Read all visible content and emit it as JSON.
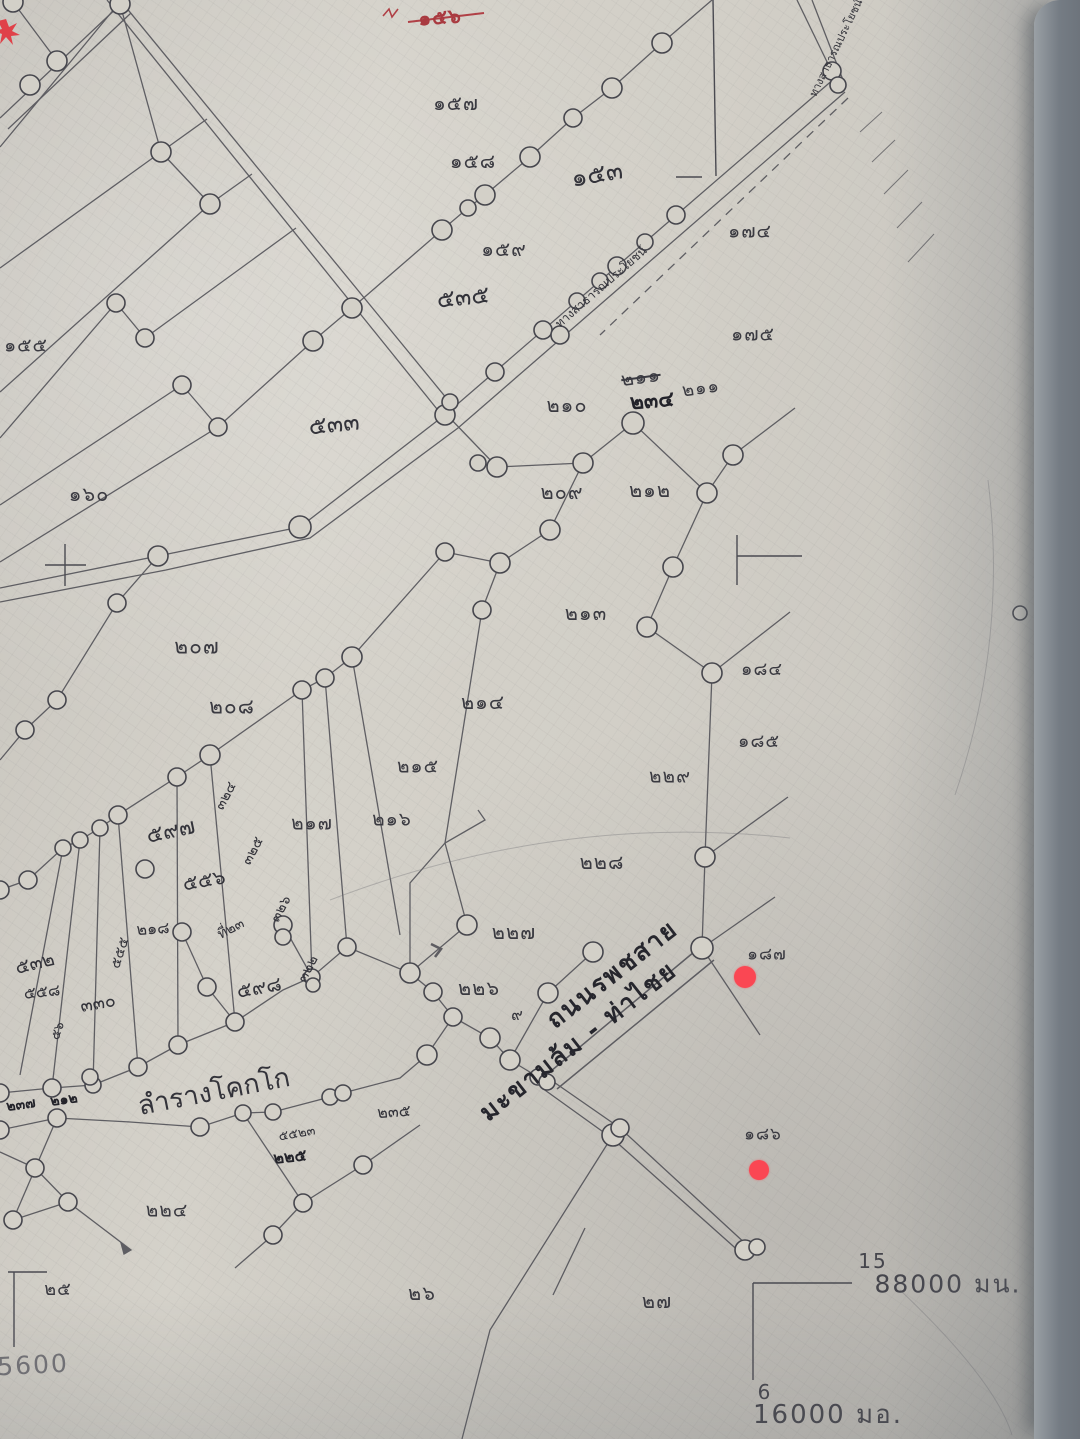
{
  "map": {
    "description": "hand-drawn cadastral survey sheet photo",
    "colors": {
      "paper": "#d2cfc7",
      "ink": "#45454c",
      "red_marker": "#fa4753",
      "red_text": "#a93a40"
    },
    "red_markers": [
      {
        "x": 745,
        "y": 977,
        "r": 11
      },
      {
        "x": 759,
        "y": 1170,
        "r": 10
      }
    ],
    "red_star": {
      "x": 6,
      "y": 31
    },
    "grid": {
      "north_index": "15",
      "north_value": "88000 มน.",
      "east_index": "6",
      "east_value": "16000 มอ.",
      "left_partial": "5600"
    },
    "road_name_line1": "ถนนรพชสาย",
    "road_name_line2": "มะขามล้ม - ท่าไชย",
    "canal_name": "ลำรางโคกโก",
    "labels": [
      {
        "name": "parcel-156-red",
        "text": "๑๕๖",
        "x": 440,
        "y": 17,
        "rot": -4,
        "size": 20,
        "cls": "red-num"
      },
      {
        "name": "parcel-157",
        "text": "๑๕๗",
        "x": 456,
        "y": 103,
        "size": 20
      },
      {
        "name": "parcel-158",
        "text": "๑๕๘",
        "x": 473,
        "y": 161,
        "size": 20
      },
      {
        "name": "parcel-159",
        "text": "๑๕๙",
        "x": 504,
        "y": 249,
        "size": 20
      },
      {
        "name": "parcel-174",
        "text": "๑๗๔",
        "x": 750,
        "y": 232,
        "size": 19
      },
      {
        "name": "parcel-175",
        "text": "๑๗๕",
        "x": 753,
        "y": 335,
        "size": 19
      },
      {
        "name": "parcel-155",
        "text": "๑๕๕",
        "x": 26,
        "y": 346,
        "size": 19
      },
      {
        "name": "parcel-160",
        "text": "๑๖๐",
        "x": 89,
        "y": 494,
        "size": 20
      },
      {
        "name": "hand-153",
        "text": "๑๕๓",
        "x": 597,
        "y": 174,
        "rot": -10,
        "size": 25,
        "cls": "hand"
      },
      {
        "name": "hand-535",
        "text": "๕๓๕",
        "x": 463,
        "y": 297,
        "rot": -6,
        "size": 24,
        "cls": "hand"
      },
      {
        "name": "hand-533",
        "text": "๕๓๓",
        "x": 334,
        "y": 424,
        "rot": -6,
        "size": 24,
        "cls": "hand"
      },
      {
        "name": "parcel-210",
        "text": "๒๑๐",
        "x": 567,
        "y": 405,
        "size": 20
      },
      {
        "name": "parcel-211-struck",
        "text": "๒๑๑",
        "x": 641,
        "y": 378,
        "rot": -8,
        "size": 19,
        "cls": "strike"
      },
      {
        "name": "parcel-234-bold",
        "text": "๒๓๔",
        "x": 652,
        "y": 401,
        "rot": -5,
        "size": 21,
        "cls": "bold-hand"
      },
      {
        "name": "parcel-211b",
        "text": "๒๑๑",
        "x": 701,
        "y": 389,
        "rot": -8,
        "size": 18
      },
      {
        "name": "parcel-209",
        "text": "๒๐๙",
        "x": 562,
        "y": 492,
        "size": 20
      },
      {
        "name": "parcel-212",
        "text": "๒๑๒",
        "x": 650,
        "y": 490,
        "size": 20
      },
      {
        "name": "parcel-213",
        "text": "๒๑๓",
        "x": 586,
        "y": 613,
        "size": 20
      },
      {
        "name": "parcel-207",
        "text": "๒๐๗",
        "x": 197,
        "y": 647,
        "size": 21
      },
      {
        "name": "parcel-208",
        "text": "๒๐๘",
        "x": 232,
        "y": 707,
        "size": 21
      },
      {
        "name": "parcel-214",
        "text": "๒๑๔",
        "x": 483,
        "y": 702,
        "size": 20
      },
      {
        "name": "parcel-215",
        "text": "๒๑๕",
        "x": 418,
        "y": 767,
        "size": 19
      },
      {
        "name": "parcel-217",
        "text": "๒๑๗",
        "x": 312,
        "y": 824,
        "size": 19
      },
      {
        "name": "parcel-216",
        "text": "๒๑๖",
        "x": 392,
        "y": 820,
        "size": 19
      },
      {
        "name": "parcel-184",
        "text": "๑๘๔",
        "x": 762,
        "y": 670,
        "size": 18
      },
      {
        "name": "parcel-185",
        "text": "๑๘๕",
        "x": 759,
        "y": 742,
        "size": 18
      },
      {
        "name": "parcel-229",
        "text": "๒๒๙",
        "x": 670,
        "y": 777,
        "size": 19
      },
      {
        "name": "parcel-228",
        "text": "๒๒๘",
        "x": 602,
        "y": 862,
        "size": 20
      },
      {
        "name": "parcel-227",
        "text": "๒๒๗",
        "x": 514,
        "y": 932,
        "size": 20
      },
      {
        "name": "parcel-226",
        "text": "๒๒๖",
        "x": 479,
        "y": 988,
        "size": 20
      },
      {
        "name": "parcel-187",
        "text": "๑๘๗",
        "x": 767,
        "y": 955,
        "size": 17
      },
      {
        "name": "parcel-186",
        "text": "๑๘๖",
        "x": 763,
        "y": 1135,
        "size": 17
      },
      {
        "name": "parcel-224",
        "text": "๒๒๔",
        "x": 167,
        "y": 1211,
        "size": 19
      },
      {
        "name": "parcel-25",
        "text": "๒๕",
        "x": 58,
        "y": 1290,
        "size": 18
      },
      {
        "name": "parcel-26",
        "text": "๒๖",
        "x": 422,
        "y": 1293,
        "size": 20
      },
      {
        "name": "parcel-27",
        "text": "๒๗",
        "x": 657,
        "y": 1301,
        "size": 20
      },
      {
        "name": "hand-597",
        "text": "๕๙๗",
        "x": 171,
        "y": 832,
        "rot": -12,
        "size": 22,
        "cls": "hand"
      },
      {
        "name": "hand-556",
        "text": "๕๕๖",
        "x": 204,
        "y": 880,
        "rot": -10,
        "size": 20,
        "cls": "hand"
      },
      {
        "name": "hand-598",
        "text": "๕๙๘",
        "x": 259,
        "y": 987,
        "rot": -10,
        "size": 20,
        "cls": "hand"
      },
      {
        "name": "hand-532",
        "text": "๕๓๒",
        "x": 35,
        "y": 964,
        "rot": -14,
        "size": 19,
        "cls": "hand"
      },
      {
        "name": "hand-558",
        "text": "๕๕๘",
        "x": 42,
        "y": 992,
        "rot": -6,
        "size": 16,
        "cls": "hand"
      },
      {
        "name": "hand-330",
        "text": "๓๓๐",
        "x": 98,
        "y": 1004,
        "rot": -10,
        "size": 18,
        "cls": "hand"
      },
      {
        "name": "hand-218",
        "text": "๒๑๘",
        "x": 153,
        "y": 929,
        "rot": -4,
        "size": 16,
        "cls": "hand"
      },
      {
        "name": "hand-note-ti23",
        "text": "ที่๒๓",
        "x": 231,
        "y": 929,
        "rot": -28,
        "size": 14,
        "cls": "hand"
      },
      {
        "name": "hand-225",
        "text": "๒๒๕",
        "x": 290,
        "y": 1157,
        "rot": -6,
        "size": 16,
        "cls": "bold-hand"
      },
      {
        "name": "hand-5523",
        "text": "๕๕๒๓",
        "x": 297,
        "y": 1134,
        "rot": -10,
        "size": 13,
        "cls": "hand"
      },
      {
        "name": "hand-235",
        "text": "๒๓๕",
        "x": 394,
        "y": 1112,
        "rot": -4,
        "size": 16,
        "cls": "hand"
      },
      {
        "name": "hand-237",
        "text": "๒๓๗",
        "x": 21,
        "y": 1105,
        "rot": -8,
        "size": 14,
        "cls": "bold-hand"
      },
      {
        "name": "hand-212b",
        "text": "๒๑๒",
        "x": 64,
        "y": 1100,
        "rot": -8,
        "size": 14,
        "cls": "bold-hand"
      },
      {
        "name": "strip-324",
        "text": "๓๒๔",
        "x": 226,
        "y": 796,
        "rot": -62,
        "size": 14,
        "cls": "hand"
      },
      {
        "name": "strip-325",
        "text": "๓๒๕",
        "x": 253,
        "y": 851,
        "rot": -62,
        "size": 14,
        "cls": "hand"
      },
      {
        "name": "strip-326",
        "text": "๓๒๖",
        "x": 281,
        "y": 909,
        "rot": -62,
        "size": 14,
        "cls": "hand"
      },
      {
        "name": "strip-322",
        "text": "๓๒๒",
        "x": 308,
        "y": 969,
        "rot": -62,
        "size": 14,
        "cls": "hand"
      },
      {
        "name": "strip-555",
        "text": "๕๕๕",
        "x": 120,
        "y": 953,
        "rot": -72,
        "size": 14,
        "cls": "hand"
      },
      {
        "name": "strip-56",
        "text": "๕๖",
        "x": 58,
        "y": 1031,
        "rot": -72,
        "size": 13,
        "cls": "hand"
      },
      {
        "name": "hand-9-mark",
        "text": "๙",
        "x": 517,
        "y": 1015,
        "rot": 0,
        "size": 16,
        "cls": "hand"
      },
      {
        "name": "road-name-line1",
        "text": "ถนนรพชสาย",
        "x": 612,
        "y": 974,
        "rot": -38,
        "size": 25,
        "cls": "road-hand"
      },
      {
        "name": "road-name-line2",
        "text": "มะขามล้ม - ท่าไชย",
        "x": 578,
        "y": 1041,
        "rot": -38,
        "size": 25,
        "cls": "road-hand"
      },
      {
        "name": "canal-name",
        "text": "ลำรางโคกโก",
        "x": 214,
        "y": 1092,
        "rot": -11,
        "size": 27,
        "cls": "hand"
      },
      {
        "name": "public-way-note",
        "text": "ทางสาธารณประโยชน์",
        "x": 601,
        "y": 287,
        "rot": -41,
        "size": 12,
        "cls": "hand"
      },
      {
        "name": "public-way-note-corner",
        "text": "ทางสาธารณประโยชน์",
        "x": 836,
        "y": 48,
        "rot": -64,
        "size": 11,
        "cls": "hand"
      },
      {
        "name": "grid-north-index",
        "text": "15",
        "x": 873,
        "y": 1261,
        "size": 20,
        "cls": "coord"
      },
      {
        "name": "grid-north-value",
        "text": "88000 มน.",
        "x": 948,
        "y": 1284,
        "size": 25,
        "cls": "coord"
      },
      {
        "name": "grid-east-index",
        "text": "6",
        "x": 765,
        "y": 1392,
        "size": 20,
        "cls": "coord"
      },
      {
        "name": "grid-east-value",
        "text": "16000 มอ.",
        "x": 828,
        "y": 1415,
        "size": 26,
        "cls": "coord"
      },
      {
        "name": "grid-left-partial",
        "text": "5600",
        "x": 33,
        "y": 1365,
        "rot": -3,
        "size": 25,
        "cls": "coord-faint"
      }
    ]
  }
}
